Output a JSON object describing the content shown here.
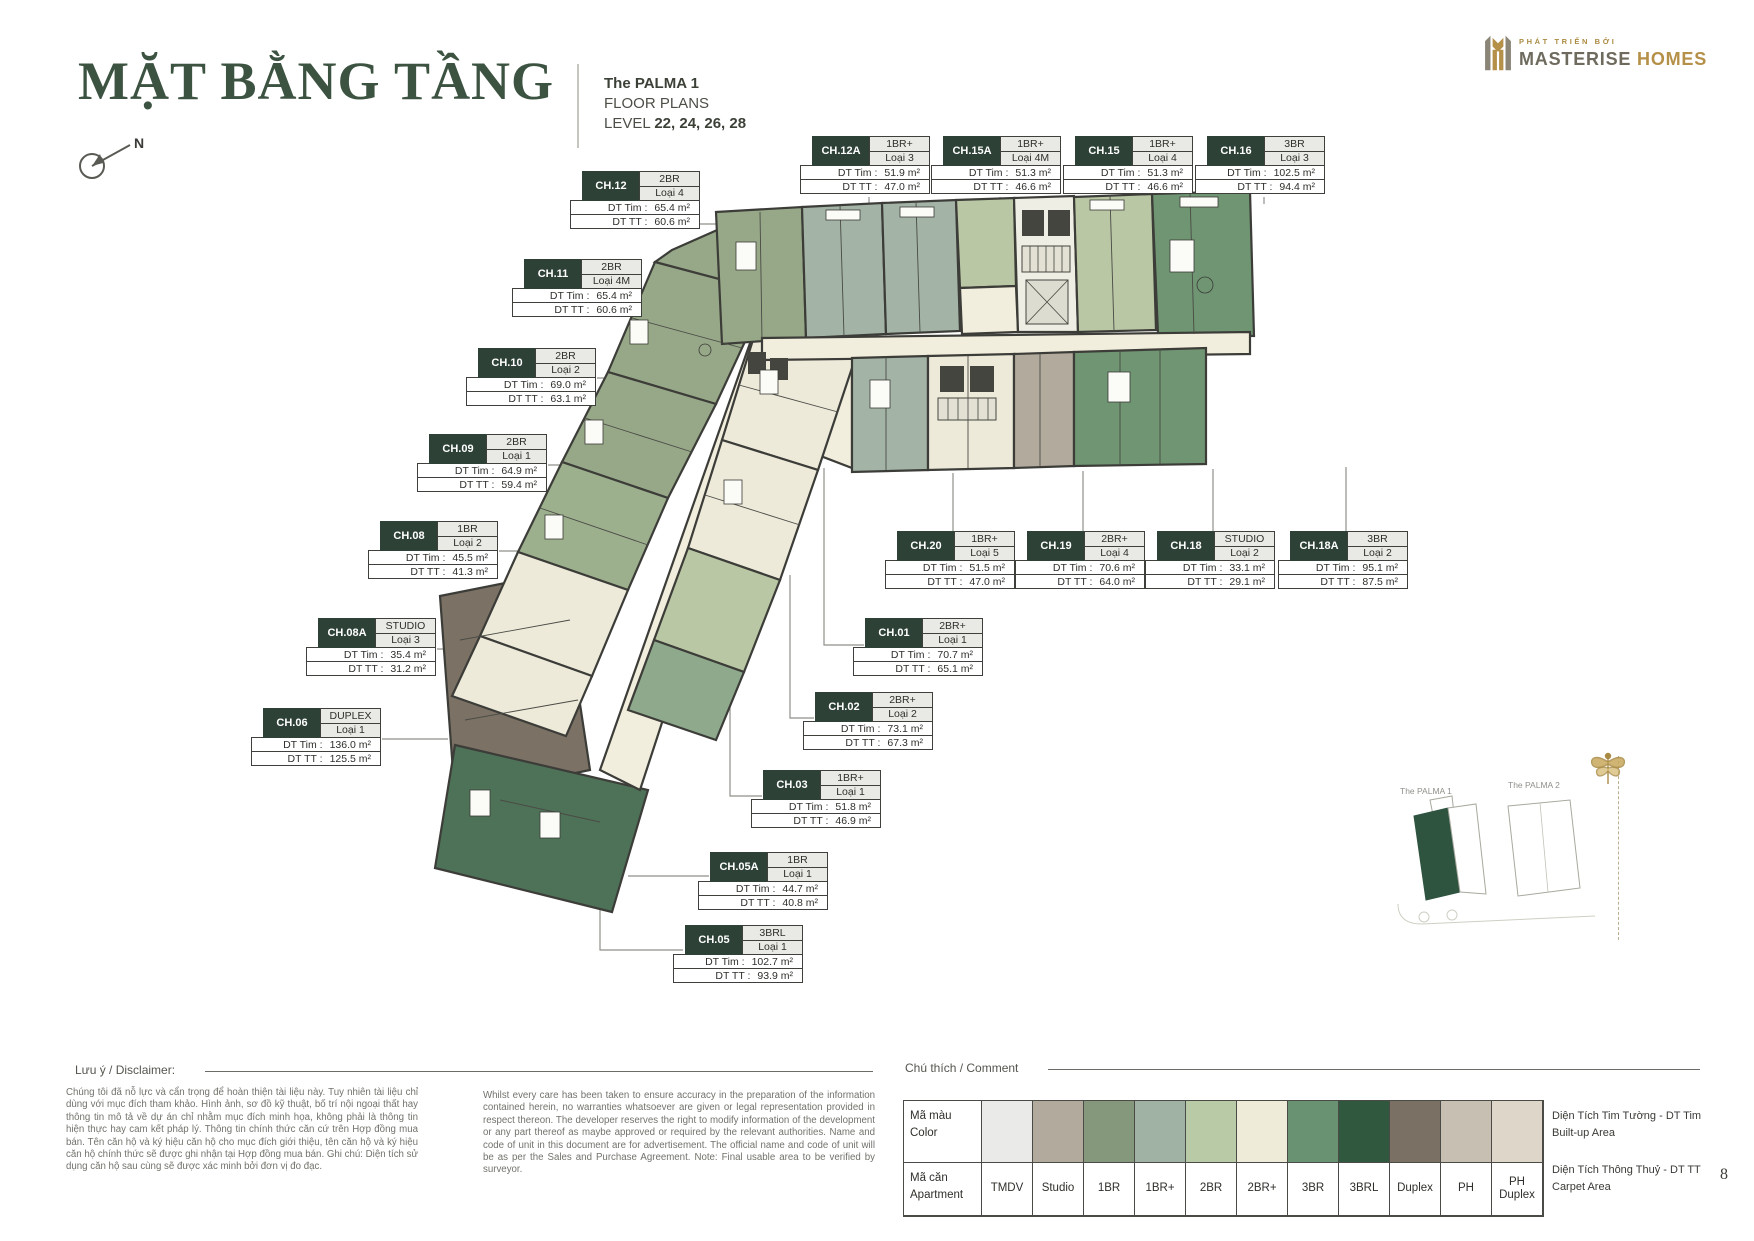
{
  "header": {
    "title": "MẶT BẰNG TẦNG",
    "project": "The PALMA 1",
    "subtitle": "FLOOR PLANS",
    "level_label": "LEVEL",
    "levels": "22, 24, 26, 28",
    "compass_n": "N",
    "accent_color": "#3d5342"
  },
  "logo": {
    "tagline": "PHÁT TRIỂN BỞI",
    "brand_primary": "MASTERISE",
    "brand_secondary": "HOMES",
    "gold_color": "#b59048"
  },
  "labels": {
    "dt_tim": "DT Tim :",
    "dt_tt": "DT TT :"
  },
  "units": [
    {
      "code": "CH.12",
      "type": "2BR",
      "variant": "Loại 4",
      "dt_tim": "65.4 m²",
      "dt_tt": "60.6 m²"
    },
    {
      "code": "CH.12A",
      "type": "1BR+",
      "variant": "Loại 3",
      "dt_tim": "51.9 m²",
      "dt_tt": "47.0 m²"
    },
    {
      "code": "CH.15A",
      "type": "1BR+",
      "variant": "Loại 4M",
      "dt_tim": "51.3 m²",
      "dt_tt": "46.6 m²"
    },
    {
      "code": "CH.15",
      "type": "1BR+",
      "variant": "Loại 4",
      "dt_tim": "51.3 m²",
      "dt_tt": "46.6 m²"
    },
    {
      "code": "CH.16",
      "type": "3BR",
      "variant": "Loại 3",
      "dt_tim": "102.5 m²",
      "dt_tt": "94.4 m²"
    },
    {
      "code": "CH.11",
      "type": "2BR",
      "variant": "Loại 4M",
      "dt_tim": "65.4 m²",
      "dt_tt": "60.6 m²"
    },
    {
      "code": "CH.10",
      "type": "2BR",
      "variant": "Loại 2",
      "dt_tim": "69.0 m²",
      "dt_tt": "63.1 m²"
    },
    {
      "code": "CH.09",
      "type": "2BR",
      "variant": "Loại 1",
      "dt_tim": "64.9 m²",
      "dt_tt": "59.4 m²"
    },
    {
      "code": "CH.08",
      "type": "1BR",
      "variant": "Loại 2",
      "dt_tim": "45.5 m²",
      "dt_tt": "41.3 m²"
    },
    {
      "code": "CH.08A",
      "type": "STUDIO",
      "variant": "Loại 3",
      "dt_tim": "35.4 m²",
      "dt_tt": "31.2 m²"
    },
    {
      "code": "CH.06",
      "type": "DUPLEX",
      "variant": "Loại 1",
      "dt_tim": "136.0 m²",
      "dt_tt": "125.5 m²"
    },
    {
      "code": "CH.20",
      "type": "1BR+",
      "variant": "Loại 5",
      "dt_tim": "51.5 m²",
      "dt_tt": "47.0 m²"
    },
    {
      "code": "CH.19",
      "type": "2BR+",
      "variant": "Loại 4",
      "dt_tim": "70.6 m²",
      "dt_tt": "64.0 m²"
    },
    {
      "code": "CH.18",
      "type": "STUDIO",
      "variant": "Loại 2",
      "dt_tim": "33.1 m²",
      "dt_tt": "29.1 m²"
    },
    {
      "code": "CH.18A",
      "type": "3BR",
      "variant": "Loại 2",
      "dt_tim": "95.1 m²",
      "dt_tt": "87.5 m²"
    },
    {
      "code": "CH.01",
      "type": "2BR+",
      "variant": "Loại 1",
      "dt_tim": "70.7 m²",
      "dt_tt": "65.1 m²"
    },
    {
      "code": "CH.02",
      "type": "2BR+",
      "variant": "Loại 2",
      "dt_tim": "73.1 m²",
      "dt_tt": "67.3 m²"
    },
    {
      "code": "CH.03",
      "type": "1BR+",
      "variant": "Loại 1",
      "dt_tim": "51.8 m²",
      "dt_tt": "46.9 m²"
    },
    {
      "code": "CH.05A",
      "type": "1BR",
      "variant": "Loại 1",
      "dt_tim": "44.7 m²",
      "dt_tt": "40.8 m²"
    },
    {
      "code": "CH.05",
      "type": "3BRL",
      "variant": "Loại 1",
      "dt_tim": "102.7 m²",
      "dt_tt": "93.9 m²"
    }
  ],
  "footer": {
    "disclaimer_title": "Lưu ý / Disclaimer:",
    "disclaimer_vi": "Chúng tôi đã nỗ lực và cẩn trọng để hoàn thiện tài liệu này. Tuy nhiên tài liệu chỉ dùng với mục đích tham khảo. Hình ảnh, sơ đồ kỹ thuật, bố trí nội ngoại thất hay thông tin mô tả về dự án chỉ nhằm mục đích minh họa, không phải là thông tin hiện thực hay cam kết pháp lý. Thông tin chính thức căn cứ trên Hợp đồng mua bán. Tên căn hộ và ký hiệu căn hộ cho mục đích giới thiệu, tên căn hộ và ký hiệu căn hộ chính thức sẽ được ghi nhận tại Hợp đồng mua bán. Ghi chú: Diện tích sử dụng căn hộ sau cùng sẽ được xác minh bởi đơn vị đo đạc.",
    "disclaimer_en": "Whilst every care has been taken to ensure accuracy in the preparation of the information contained herein, no warranties whatsoever are given or legal representation provided in respect thereon. The developer reserves the right to modify information of the development or any part thereof as maybe approved or required by the relevant authorities. Name and code of unit in this document are for advertisement. The official name and code of unit will be as per the Sales and Purchase Agreement. Note: Final usable area to be verified by surveyor.",
    "legend_title": "Chú thích / Comment",
    "legend": {
      "color_label_vi": "Mã màu",
      "color_label_en": "Color",
      "apt_label_vi": "Mã căn",
      "apt_label_en": "Apartment",
      "items": [
        {
          "label": "TMDV",
          "color": "#eaeae8"
        },
        {
          "label": "Studio",
          "color": "#b2ab9d"
        },
        {
          "label": "1BR",
          "color": "#86987b"
        },
        {
          "label": "1BR+",
          "color": "#9fb2a4"
        },
        {
          "label": "2BR",
          "color": "#b9caa7"
        },
        {
          "label": "2BR+",
          "color": "#eeecd9"
        },
        {
          "label": "3BR",
          "color": "#689272"
        },
        {
          "label": "3BRL",
          "color": "#30583f"
        },
        {
          "label": "Duplex",
          "color": "#7a7164"
        },
        {
          "label": "PH",
          "color": "#c7bfb1"
        },
        {
          "label": "PH Duplex",
          "color": "#ded7c9"
        }
      ]
    },
    "area_notes": [
      {
        "vi": "Diện Tích Tim Tường - DT Tim",
        "en": "Built-up Area"
      },
      {
        "vi": "Diện Tích Thông Thuỷ - DT TT",
        "en": "Carpet Area"
      }
    ],
    "page_number": "8"
  },
  "minimap": {
    "label_1": "The PALMA 1",
    "label_2": "The PALMA 2",
    "highlight_color": "#2e5440"
  }
}
